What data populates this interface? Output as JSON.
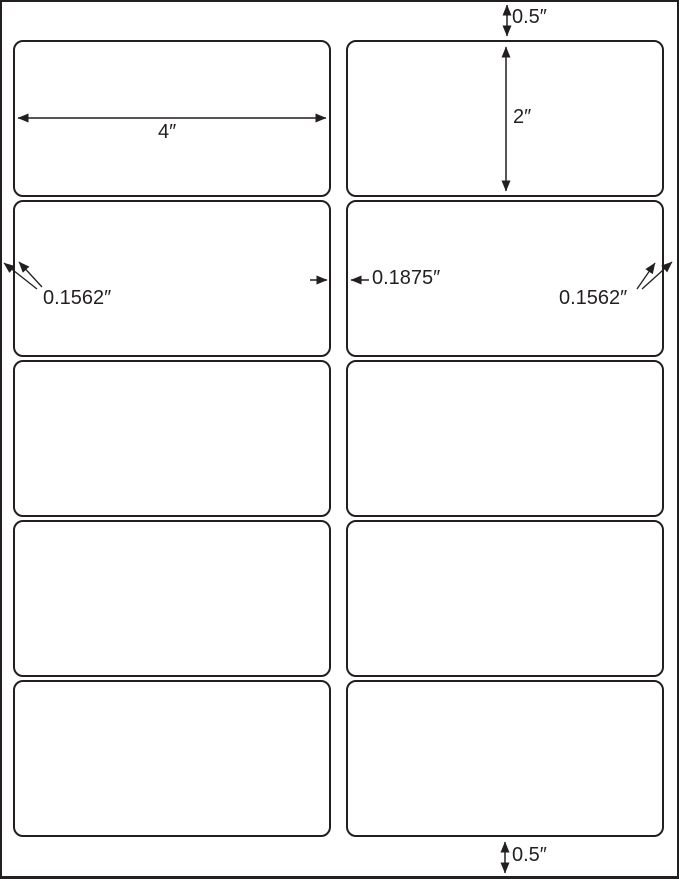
{
  "diagram": {
    "type": "label-sheet-dimension-diagram",
    "grid": {
      "rows": 5,
      "columns": 2
    },
    "colors": {
      "line": "#231f20",
      "background": "#ffffff"
    },
    "dimensions": {
      "top_margin": "0.5″",
      "label_height": "2″",
      "label_width": "4″",
      "left_margin": "0.1562″",
      "column_gap": "0.1875″",
      "right_margin": "0.1562″",
      "bottom_margin": "0.5″"
    }
  }
}
